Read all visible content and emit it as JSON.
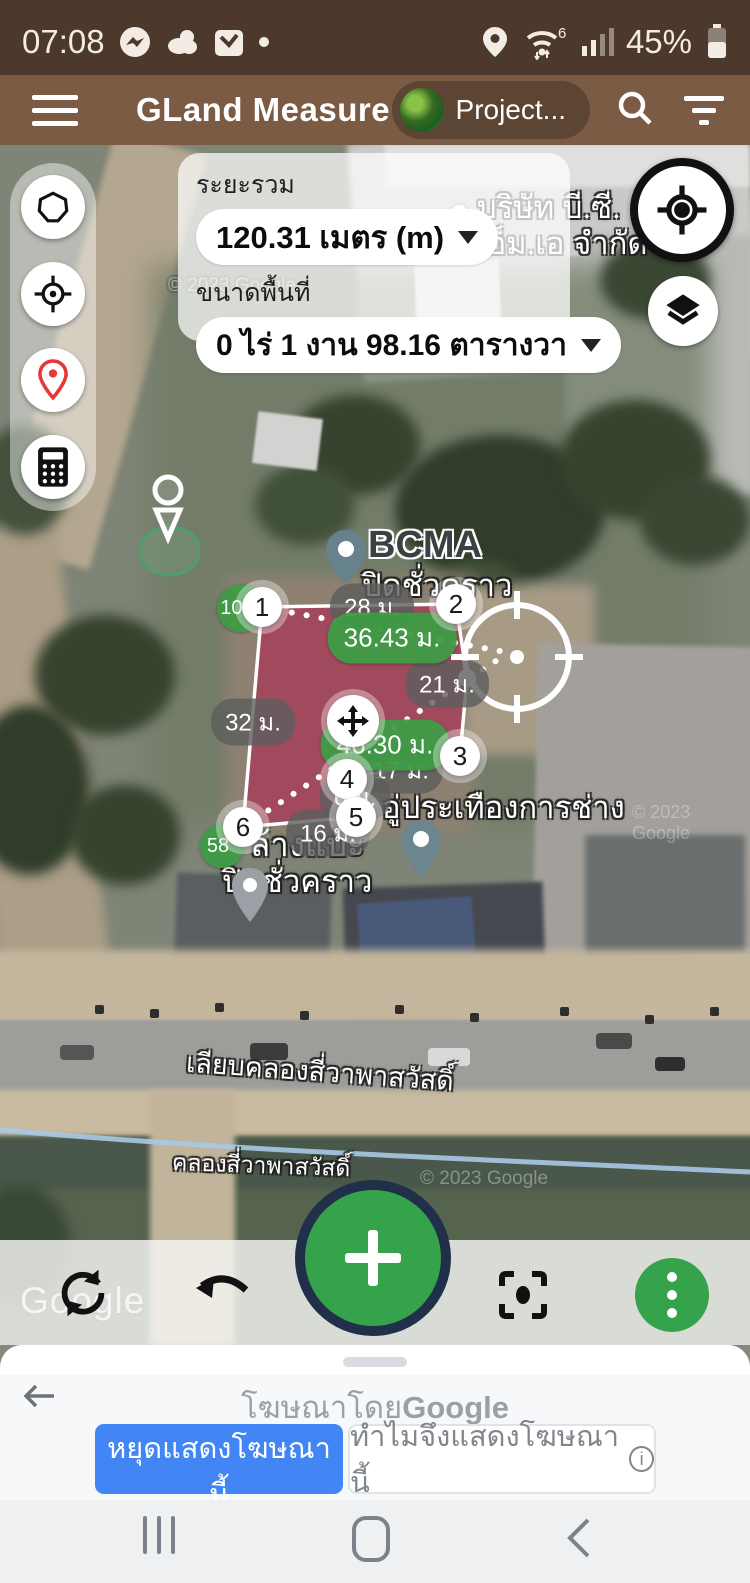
{
  "status_bar": {
    "time": "07:08",
    "battery": "45%",
    "wifi_standard": "6"
  },
  "app_bar": {
    "title": "GLand Measure",
    "project_button": "Project..."
  },
  "measure_panel": {
    "distance_label": "ระยะรวม",
    "distance_value": "120.31 เมตร (m)",
    "area_label": "ขนาดพื้นที่",
    "area_value": "0 ไร่ 1 งาน 98.16 ตารางวา"
  },
  "map": {
    "company": {
      "line1": "บริษัท บี.ซี.",
      "line2": "เอ็ม.เอ จำกัด"
    },
    "bcma": {
      "name": "BCMA",
      "status": "ปิดชั่วคราว"
    },
    "garage": {
      "name": "อู่ประเทืองการช่าง"
    },
    "closed_shop": {
      "name": "ล้างแบ๊ะ",
      "status": "ปิดชั่วคราว"
    },
    "road_label": "เลียบคลองสี่วาพาสวัสดิ์",
    "canal_label": "คลองสี่วาพาสวัสดิ์",
    "vertices": [
      {
        "n": "1"
      },
      {
        "n": "2"
      },
      {
        "n": "3"
      },
      {
        "n": "4"
      },
      {
        "n": "5"
      },
      {
        "n": "6"
      }
    ],
    "edge_labels": [
      {
        "text": "28 ม."
      },
      {
        "text": "21 ม."
      },
      {
        "text": "17 ม."
      },
      {
        "text": "6 ม."
      },
      {
        "text": "16 ม."
      },
      {
        "text": "32 ม."
      }
    ],
    "measure_labels": [
      {
        "text": "36.43 ม."
      },
      {
        "text": "46.30 ม."
      }
    ],
    "angle_labels": [
      {
        "text": "100°"
      },
      {
        "text": "58°"
      }
    ],
    "watermark": "Google",
    "imagery_credit": "© 2023 Google"
  },
  "ad_banner": {
    "title_prefix": "โฆษณาโดย",
    "title_brand": "Google",
    "stop_button": "หยุดแสดงโฆษณานี้",
    "why_button": "ทำไมจึงแสดงโฆษณานี้",
    "info_symbol": "i"
  },
  "colors": {
    "status_bar": "#4c392b",
    "app_bar": "#7b5b43",
    "accent_green": "#35a24c",
    "polygon_fill": "#b01e4e",
    "ad_button_blue": "#4285f4"
  }
}
